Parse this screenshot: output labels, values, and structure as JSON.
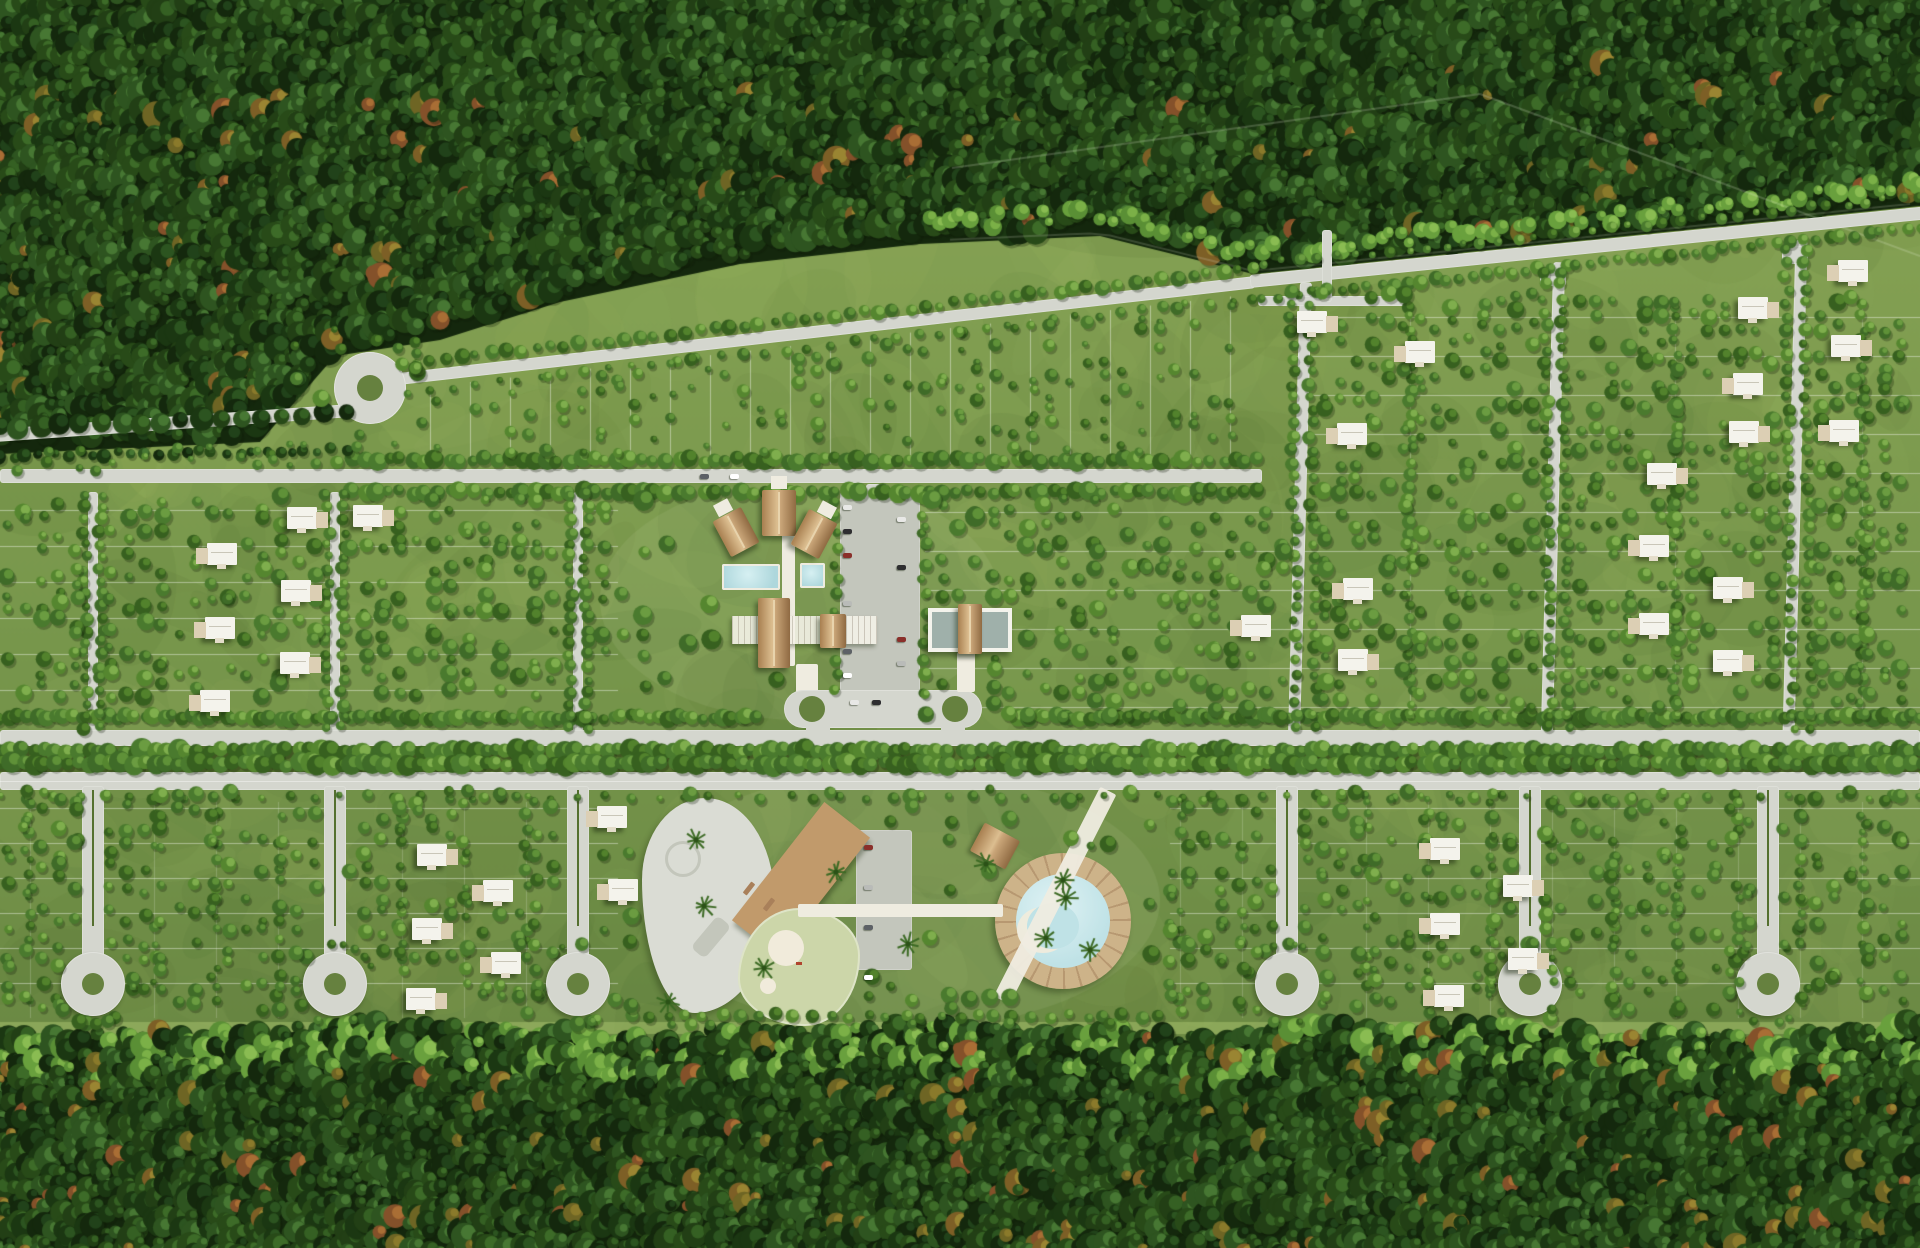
{
  "meta": {
    "description": "Aerial 3D masterplan rendering of a residential lot development carved into dense jungle, with tree-lined roads, a central clubhouse with lap pools, a lagoon pool amenity zone, skatepark, parking areas, scattered white villas and lollipop cul-de-sacs",
    "canvas_width": 1920,
    "canvas_height": 1248
  },
  "colors": {
    "grass_top": "#86a254",
    "grass_mid": "#78974c",
    "grass_bottom": "#698743",
    "mottle_dark": "#3c5a22",
    "mottle_light": "#a9c26a",
    "forest_base": "#14270d",
    "road": "#d4d6ce",
    "road_dark": "#c3c6bc",
    "median_green": "#55702f",
    "walkway": "#efece0",
    "lot_line": "rgba(255,255,255,0.42)",
    "thatch_grad": "linear-gradient(90deg,#a87f50,#dcbe90 45%,#c9a578 55%,#8f6a42)",
    "thatch_flat": "#c9a578",
    "pool": "#aed7dc",
    "pool_light": "#d6f0f2",
    "lagoon": "#bfe2e6",
    "sand": "#f1ebdb",
    "deck_wood": "#c19a6b",
    "skate": "#dadcd4",
    "skate_detail": "#c3c6bb",
    "pond": "#ccd6a9",
    "villa": "#f4f3ec",
    "villa_terrace": "#dccfb4",
    "island_grass": "#66813f",
    "shadow": "rgba(22,36,10,0.5)",
    "car_colors": [
      "#e8e8e6",
      "#2e2e30",
      "#8a2f2a",
      "#b9bbb8",
      "#5d6166",
      "#ffffff"
    ]
  },
  "forest": {
    "top_boundary": [
      [
        0,
        448
      ],
      [
        260,
        436
      ],
      [
        335,
        350
      ],
      [
        440,
        334
      ],
      [
        560,
        296
      ],
      [
        740,
        258
      ],
      [
        920,
        238
      ],
      [
        1100,
        230
      ],
      [
        1253,
        268
      ],
      [
        1920,
        200
      ]
    ],
    "bottom_edge_y": 1034,
    "palette": [
      [
        "#14280d",
        "#21421a"
      ],
      [
        "#1b3712",
        "#2c5420"
      ],
      [
        "#223f15",
        "#356023"
      ],
      [
        "#284a18",
        "#3d6b28"
      ],
      [
        "#2e5420",
        "#477733"
      ]
    ],
    "autumn_palette": [
      [
        "#6e6524",
        "#8a7a2b"
      ],
      [
        "#7d5f26",
        "#9a8532"
      ],
      [
        "#84512a",
        "#a96e35"
      ]
    ],
    "bright_palette": [
      [
        "#5a8f35",
        "#7bb047"
      ],
      [
        "#69a03d",
        "#8abc52"
      ]
    ],
    "boundary_lines": [
      [
        952,
        168,
        1480,
        94
      ],
      [
        1480,
        94,
        1920,
        256
      ]
    ]
  },
  "roads": {
    "entrance": {
      "x": -6,
      "y": 429,
      "w": 356,
      "h": 13,
      "rot": -4
    },
    "wedge_top": {
      "x": 398,
      "y": 373,
      "w": 862,
      "h": 12,
      "rot": -6.45
    },
    "upper": {
      "x": 0,
      "y": 469,
      "w": 1262,
      "h": 14,
      "rot": 0
    },
    "grid_top": {
      "x": 1250,
      "y": 275,
      "w": 676,
      "h": 13,
      "rot": -5.8
    },
    "grid_verticals": [
      {
        "x": 1294,
        "y": 282,
        "w": 12,
        "h": 452,
        "rot": 1.5
      },
      {
        "x": 1547,
        "y": 262,
        "w": 12,
        "h": 472,
        "rot": 1.5
      },
      {
        "x": 1789,
        "y": 240,
        "w": 12,
        "h": 494,
        "rot": 1.5
      }
    ],
    "stubs": [
      {
        "x": 1258,
        "y": 296,
        "w": 150,
        "h": 10,
        "rot": 0
      },
      {
        "x": 1322,
        "y": 230,
        "w": 10,
        "h": 72,
        "rot": 0
      },
      {
        "x": 1540,
        "y": 268,
        "w": 26,
        "h": 18,
        "rot": 0
      },
      {
        "x": 1782,
        "y": 246,
        "w": 26,
        "h": 18,
        "rot": 0
      },
      {
        "x": 866,
        "y": 484,
        "w": 22,
        "h": 18,
        "rot": 0
      }
    ],
    "left_streets": {
      "xs": [
        93,
        335,
        578
      ],
      "y": 492,
      "h": 240,
      "w": 10
    }
  },
  "roundabout": {
    "cx": 370,
    "cy": 388,
    "r": 36,
    "island_r": 13
  },
  "boulevard": {
    "north_y": 730,
    "north_h": 16,
    "median_y": 746,
    "median_h": 26,
    "south_y": 772,
    "south_h": 18
  },
  "culdesacs": {
    "stem_xs": [
      93,
      335,
      578,
      1287,
      1530,
      1768
    ],
    "stem_top": 786,
    "stem_h": 176,
    "stem_w": 22,
    "circle_cy": 984,
    "circle_r": 32,
    "hole_r": 11
  },
  "parking": {
    "x": 840,
    "y": 492,
    "w": 80,
    "h": 210
  },
  "amenity_parking": {
    "x": 856,
    "y": 830,
    "w": 56,
    "h": 140
  },
  "clubhouse": {
    "cabins": [
      {
        "x": 720,
        "y": 512,
        "w": 32,
        "h": 40,
        "rot": -28
      },
      {
        "x": 762,
        "y": 490,
        "w": 34,
        "h": 46,
        "rot": 0
      },
      {
        "x": 798,
        "y": 514,
        "w": 32,
        "h": 40,
        "rot": 28
      }
    ],
    "spine": {
      "x": 782,
      "y": 498,
      "w": 13,
      "h": 168
    },
    "pools": [
      {
        "x": 722,
        "y": 564,
        "w": 58,
        "h": 26
      },
      {
        "x": 800,
        "y": 563,
        "w": 25,
        "h": 25
      }
    ],
    "deck_bar": {
      "x": 732,
      "y": 616,
      "w": 145,
      "h": 28
    },
    "hall": {
      "x": 758,
      "y": 598,
      "w": 32,
      "h": 70
    },
    "pavilion": {
      "x": 820,
      "y": 614,
      "w": 26,
      "h": 34
    },
    "steps": {
      "x": 796,
      "y": 664,
      "w": 22,
      "h": 30
    },
    "loop": {
      "x": 784,
      "y": 690,
      "w": 198,
      "h": 38
    },
    "loop_islands": [
      {
        "cx": 812,
        "cy": 709,
        "r": 13
      },
      {
        "cx": 955,
        "cy": 709,
        "r": 13
      }
    ],
    "loop_connectors": [
      {
        "x": 806,
        "y": 722,
        "w": 24,
        "h": 12
      },
      {
        "x": 941,
        "y": 722,
        "w": 24,
        "h": 12
      }
    ],
    "event_center": {
      "x": 928,
      "y": 608,
      "w": 84,
      "h": 44
    },
    "event_glazing": [
      {
        "x": 932,
        "y": 612,
        "w": 26,
        "h": 36
      },
      {
        "x": 982,
        "y": 612,
        "w": 26,
        "h": 36
      }
    ],
    "event_roof": {
      "x": 958,
      "y": 604,
      "w": 24,
      "h": 50
    },
    "event_steps": {
      "x": 957,
      "y": 652,
      "w": 18,
      "h": 40
    }
  },
  "amenity": {
    "skatepark": {
      "x": 642,
      "y": 798,
      "w": 132,
      "h": 215
    },
    "skate_ring": {
      "cx": 680,
      "cy": 856,
      "r": 15
    },
    "skate_ramp": {
      "x": 690,
      "y": 928,
      "w": 42,
      "h": 18,
      "rot": -50
    },
    "wood_deck": {
      "x": 726,
      "y": 850,
      "w": 150,
      "h": 58,
      "rot": -52
    },
    "chairs": [
      [
        742,
        886
      ],
      [
        762,
        902
      ],
      [
        782,
        918
      ]
    ],
    "pond": {
      "x": 738,
      "y": 908,
      "w": 122,
      "h": 118
    },
    "pond_sand_big": {
      "cx": 786,
      "cy": 948,
      "r": 18
    },
    "pond_sand_small": {
      "cx": 768,
      "cy": 986,
      "r": 8
    },
    "lagoon": {
      "cx": 1063,
      "cy": 921,
      "ring_r": 68,
      "water_r": 47
    },
    "palapa": {
      "x": 975,
      "y": 830,
      "w": 40,
      "h": 32,
      "rot": 28
    },
    "diag_path": {
      "x": 1046,
      "y": 778,
      "w": 18,
      "h": 235,
      "rot": 27
    },
    "walk_h": {
      "x": 798,
      "y": 904,
      "w": 205,
      "h": 13
    }
  },
  "villas": [
    [
      222,
      554,
      "l"
    ],
    [
      302,
      518,
      "r"
    ],
    [
      296,
      591,
      "r"
    ],
    [
      220,
      628,
      "l"
    ],
    [
      295,
      663,
      "r"
    ],
    [
      215,
      701,
      "l"
    ],
    [
      368,
      516,
      "r"
    ],
    [
      1256,
      626,
      "l"
    ],
    [
      1352,
      434,
      "l"
    ],
    [
      1744,
      432,
      "r"
    ],
    [
      1844,
      431,
      "l"
    ],
    [
      1846,
      346,
      "r"
    ],
    [
      1853,
      271,
      "l"
    ],
    [
      1753,
      308,
      "r"
    ],
    [
      1748,
      384,
      "l"
    ],
    [
      1662,
      474,
      "r"
    ],
    [
      1654,
      546,
      "l"
    ],
    [
      1728,
      588,
      "r"
    ],
    [
      1654,
      624,
      "l"
    ],
    [
      1728,
      661,
      "r"
    ],
    [
      1358,
      589,
      "l"
    ],
    [
      1353,
      660,
      "r"
    ],
    [
      1312,
      322,
      "r"
    ],
    [
      1420,
      352,
      "l"
    ],
    [
      432,
      855,
      "r"
    ],
    [
      498,
      891,
      "l"
    ],
    [
      427,
      929,
      "r"
    ],
    [
      506,
      963,
      "l"
    ],
    [
      421,
      999,
      "r"
    ],
    [
      612,
      817,
      "l"
    ],
    [
      623,
      890,
      "l"
    ],
    [
      1445,
      849,
      "l"
    ],
    [
      1518,
      886,
      "r"
    ],
    [
      1445,
      924,
      "l"
    ],
    [
      1523,
      959,
      "r"
    ],
    [
      1449,
      996,
      "l"
    ]
  ],
  "cars": {
    "parking": [
      [
        843,
        505
      ],
      [
        843,
        529
      ],
      [
        843,
        553
      ],
      [
        843,
        601
      ],
      [
        843,
        649
      ],
      [
        843,
        673
      ],
      [
        897,
        517
      ],
      [
        897,
        565
      ],
      [
        897,
        637
      ],
      [
        897,
        661
      ]
    ],
    "roads": [
      [
        700,
        474
      ],
      [
        730,
        474
      ],
      [
        850,
        700
      ],
      [
        872,
        700
      ]
    ],
    "amenity": [
      [
        864,
        845
      ],
      [
        864,
        885
      ],
      [
        864,
        925
      ],
      [
        864,
        975
      ]
    ]
  },
  "lot_lines": {
    "leftmid_rows": {
      "x0": 0,
      "x1": 618,
      "y0": 510,
      "y1": 690,
      "step": 36
    },
    "eparking_rows": {
      "x0": 925,
      "x1": 1292,
      "y0": 512,
      "y1": 716,
      "step": 39
    },
    "rightgrid_rows": {
      "x0": 1292,
      "x1": 1920,
      "y0": 317,
      "y1": 710,
      "step": 39
    },
    "bottomL_rows": {
      "x0": 0,
      "x1": 618,
      "y0": 808,
      "y1": 1016,
      "step": 35
    },
    "bottomR_rows": {
      "x0": 1170,
      "x1": 1920,
      "y0": 808,
      "y1": 1016,
      "step": 35
    },
    "wedge_fan": {
      "x0": 430,
      "x1": 1240,
      "step": 40,
      "y_bottom": 464
    },
    "rightgrid_cols": [
      1410,
      1675,
      1862
    ],
    "bottom_col_step": 62
  },
  "veg": {
    "dev_palette": [
      [
        "#3f6b28",
        "#5f9138"
      ],
      [
        "#4a7a2e",
        "#6b9c41"
      ],
      [
        "#55862f",
        "#7fae4d"
      ],
      [
        "#37601f",
        "#52822c"
      ]
    ],
    "rows": [
      {
        "a": [
          400,
          364
        ],
        "b": [
          1253,
          270
        ],
        "s": 15,
        "r": [
          4,
          8
        ]
      },
      {
        "a": [
          408,
          392
        ],
        "b": [
          1253,
          298
        ],
        "s": 22,
        "r": [
          3,
          6
        ]
      },
      {
        "a": [
          352,
          460
        ],
        "b": [
          1258,
          460
        ],
        "s": 12,
        "r": [
          5,
          10
        ]
      },
      {
        "a": [
          352,
          492
        ],
        "b": [
          1258,
          492
        ],
        "s": 12,
        "r": [
          5,
          10
        ]
      },
      {
        "a": [
          1262,
          298
        ],
        "b": [
          1920,
          228
        ],
        "s": 13,
        "r": [
          4,
          8
        ]
      },
      {
        "a": [
          1262,
          264
        ],
        "b": [
          1920,
          196
        ],
        "s": 18,
        "r": [
          3,
          6
        ]
      },
      {
        "a": [
          0,
          751
        ],
        "b": [
          1920,
          751
        ],
        "s": 11,
        "r": [
          6,
          11
        ]
      },
      {
        "a": [
          0,
          764
        ],
        "b": [
          1920,
          764
        ],
        "s": 11,
        "r": [
          6,
          11
        ]
      },
      {
        "a": [
          0,
          717
        ],
        "b": [
          1920,
          717
        ],
        "s": 9,
        "r": [
          5,
          9
        ],
        "skip": [
          [
            758,
            1010
          ]
        ]
      },
      {
        "a": [
          0,
          797
        ],
        "b": [
          1920,
          797
        ],
        "s": 26,
        "r": [
          3,
          6
        ]
      },
      {
        "a": [
          85,
          496
        ],
        "b": [
          85,
          728
        ],
        "s": 12,
        "r": [
          4,
          7
        ]
      },
      {
        "a": [
          101,
          496
        ],
        "b": [
          101,
          728
        ],
        "s": 12,
        "r": [
          4,
          7
        ]
      },
      {
        "a": [
          327,
          496
        ],
        "b": [
          327,
          728
        ],
        "s": 12,
        "r": [
          4,
          7
        ]
      },
      {
        "a": [
          343,
          496
        ],
        "b": [
          343,
          728
        ],
        "s": 12,
        "r": [
          4,
          7
        ]
      },
      {
        "a": [
          570,
          496
        ],
        "b": [
          570,
          728
        ],
        "s": 12,
        "r": [
          4,
          7
        ]
      },
      {
        "a": [
          586,
          496
        ],
        "b": [
          586,
          728
        ],
        "s": 12,
        "r": [
          4,
          7
        ]
      },
      {
        "a": [
          1291,
          292
        ],
        "b": [
          1297,
          728
        ],
        "s": 13,
        "r": [
          4,
          7
        ]
      },
      {
        "a": [
          1309,
          292
        ],
        "b": [
          1315,
          728
        ],
        "s": 13,
        "r": [
          4,
          7
        ]
      },
      {
        "a": [
          1544,
          272
        ],
        "b": [
          1550,
          728
        ],
        "s": 13,
        "r": [
          4,
          7
        ]
      },
      {
        "a": [
          1562,
          272
        ],
        "b": [
          1568,
          728
        ],
        "s": 13,
        "r": [
          4,
          7
        ]
      },
      {
        "a": [
          1786,
          250
        ],
        "b": [
          1792,
          728
        ],
        "s": 13,
        "r": [
          4,
          7
        ]
      },
      {
        "a": [
          1804,
          250
        ],
        "b": [
          1810,
          728
        ],
        "s": 13,
        "r": [
          4,
          7
        ]
      },
      {
        "a": [
          836,
          500
        ],
        "b": [
          836,
          692
        ],
        "s": 15,
        "r": [
          4,
          7
        ]
      },
      {
        "a": [
          924,
          500
        ],
        "b": [
          924,
          692
        ],
        "s": 15,
        "r": [
          4,
          7
        ]
      },
      {
        "a": [
          1410,
          305
        ],
        "b": [
          1410,
          715
        ],
        "s": 12,
        "r": [
          4,
          7
        ]
      },
      {
        "a": [
          1675,
          305
        ],
        "b": [
          1675,
          715
        ],
        "s": 12,
        "r": [
          4,
          7
        ]
      },
      {
        "a": [
          1862,
          305
        ],
        "b": [
          1862,
          715
        ],
        "s": 12,
        "r": [
          4,
          7
        ]
      },
      {
        "a": [
          0,
          456
        ],
        "b": [
          345,
          450
        ],
        "s": 13,
        "r": [
          4,
          8
        ],
        "pal": "forest"
      },
      {
        "a": [
          0,
          428
        ],
        "b": [
          345,
          414
        ],
        "s": 20,
        "r": [
          7,
          12
        ],
        "pal": "forest"
      },
      {
        "a": [
          630,
          1016
        ],
        "b": [
          1160,
          1016
        ],
        "s": 18,
        "r": [
          4,
          7
        ]
      }
    ],
    "scatters": [
      {
        "x0": 420,
        "x1": 1240,
        "y0": 300,
        "y1": 456,
        "cell": 18,
        "p": 0.5,
        "r": [
          3,
          7
        ],
        "clip": "wedge"
      },
      {
        "x0": 8,
        "x1": 618,
        "y0": 504,
        "y1": 700,
        "cell": 17,
        "p": 0.6,
        "r": [
          4,
          9
        ]
      },
      {
        "x0": 925,
        "x1": 1288,
        "y0": 506,
        "y1": 712,
        "cell": 17,
        "p": 0.6,
        "r": [
          4,
          9
        ]
      },
      {
        "x0": 622,
        "x1": 985,
        "y0": 500,
        "y1": 696,
        "cell": 22,
        "p": 0.22,
        "r": [
          5,
          11
        ]
      },
      {
        "x0": 1292,
        "x1": 1914,
        "y0": 300,
        "y1": 708,
        "cell": 16,
        "p": 0.55,
        "r": [
          4,
          9
        ]
      },
      {
        "x0": 8,
        "x1": 618,
        "y0": 798,
        "y1": 1018,
        "cell": 17,
        "p": 0.55,
        "r": [
          4,
          8
        ]
      },
      {
        "x0": 1170,
        "x1": 1914,
        "y0": 798,
        "y1": 1018,
        "cell": 17,
        "p": 0.55,
        "r": [
          4,
          8
        ]
      },
      {
        "x0": 630,
        "x1": 1165,
        "y0": 796,
        "y1": 1024,
        "cell": 20,
        "p": 0.3,
        "r": [
          4,
          9
        ]
      },
      {
        "x0": 295,
        "x1": 430,
        "y0": 335,
        "y1": 455,
        "cell": 20,
        "p": 0.35,
        "r": [
          3,
          7
        ]
      },
      {
        "x0": 0,
        "x1": 350,
        "y0": 448,
        "y1": 466,
        "cell": 16,
        "p": 0.4,
        "r": [
          3,
          6
        ]
      }
    ],
    "palms": [
      [
        696,
        840
      ],
      [
        704,
        906
      ],
      [
        764,
        968
      ],
      [
        836,
        872
      ],
      [
        986,
        864
      ],
      [
        1066,
        898
      ],
      [
        1090,
        950
      ],
      [
        1046,
        938
      ],
      [
        668,
        1002
      ],
      [
        908,
        944
      ],
      [
        1063,
        880
      ]
    ]
  }
}
